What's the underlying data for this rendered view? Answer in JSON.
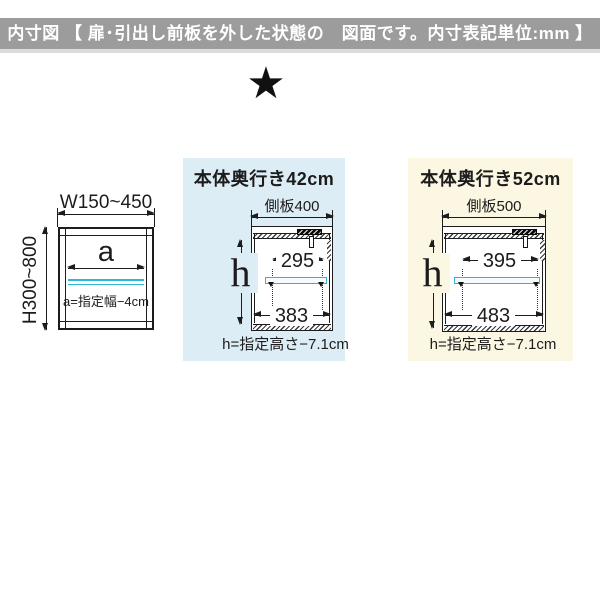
{
  "colors": {
    "header_bg": "#9c9c9c",
    "panel_blue": "#ddedf5",
    "panel_yellow": "#fbf7e2",
    "shelf_cyan": "#2eb6d8",
    "line": "#1c1c1c"
  },
  "header": {
    "title": "内寸図 【 扉･引出し前板を外した状態の　図面です。内寸表記単位:mm 】"
  },
  "marker": {
    "star": "★"
  },
  "front_diagram": {
    "width_range": "W150~450",
    "height_range": "H300~800",
    "inner_width_symbol": "a",
    "formula": "a=指定幅−4cm"
  },
  "depth42_diagram": {
    "title": "本体奥行き42cm",
    "side_panel": "側板400",
    "hole_pitch_width": "295",
    "inner_width": "383",
    "height_symbol": "h",
    "formula": "h=指定高さ−7.1cm"
  },
  "depth52_diagram": {
    "title": "本体奥行き52cm",
    "side_panel": "側板500",
    "hole_pitch_width": "395",
    "inner_width": "483",
    "height_symbol": "h",
    "formula": "h=指定高さ−7.1cm"
  }
}
